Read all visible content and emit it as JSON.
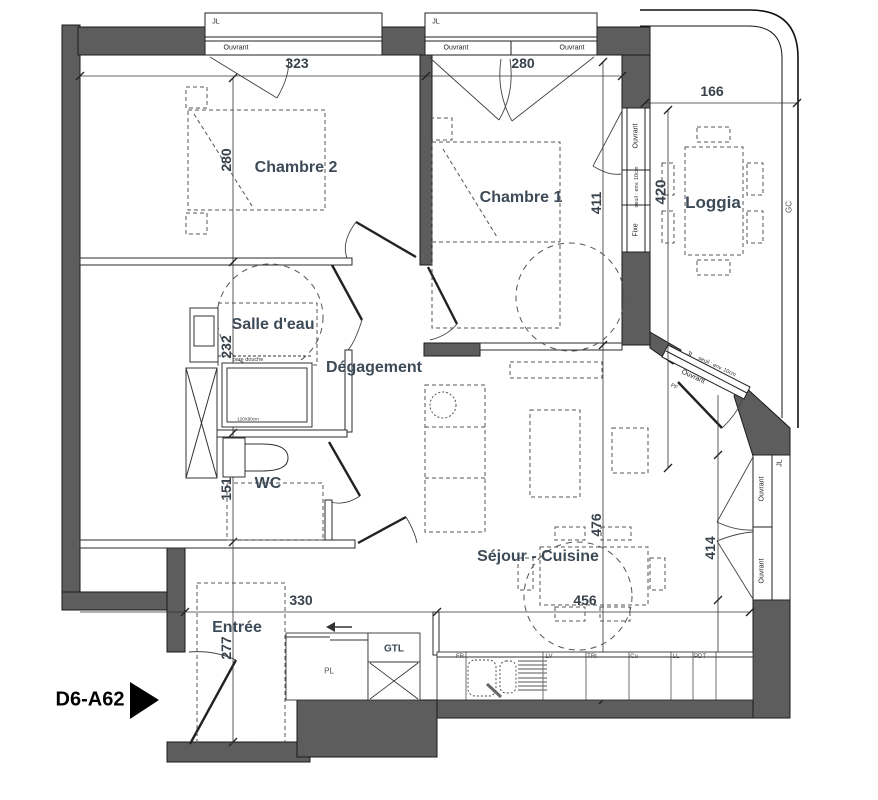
{
  "unit": {
    "label": "D6-A62"
  },
  "rooms": {
    "chambre2": {
      "name": "Chambre 2",
      "width": "323",
      "height": "280"
    },
    "chambre1": {
      "name": "Chambre 1",
      "width": "280",
      "height": "411"
    },
    "loggia": {
      "name": "Loggia",
      "width": "166",
      "height": "420"
    },
    "salle_deau": {
      "name": "Salle d'eau",
      "height": "232"
    },
    "degagement": {
      "name": "Dégagement"
    },
    "wc": {
      "name": "WC",
      "height": "151"
    },
    "sejour": {
      "name": "Séjour - Cuisine",
      "height": "476",
      "width": "456",
      "window_wall": "414"
    },
    "entree": {
      "name": "Entrée",
      "width": "330",
      "height": "277"
    }
  },
  "openings": {
    "jl": "JL",
    "ouvrant": "Ouvrant",
    "fixe": "Fixe",
    "pf": "PF",
    "seuil": "seuil : env. 10cm",
    "gc": "GC"
  },
  "fixtures": {
    "gtl": "GTL",
    "pl": "PL",
    "pare_douche": "pare douche",
    "shower_size": "120X90cm"
  },
  "kitchen": {
    "labels": [
      "FR",
      "LV",
      "TRI",
      "Cu",
      "LL",
      "PDT"
    ]
  },
  "colors": {
    "wall": "#5d5d5d",
    "room_label": "#3d4a57",
    "dim_label": "#39424b"
  }
}
